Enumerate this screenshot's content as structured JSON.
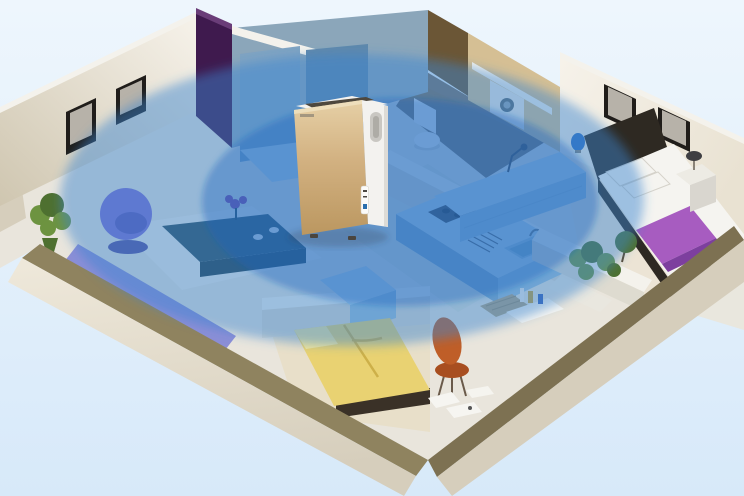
{
  "rooms": [
    "living-room",
    "hallway-closet",
    "bathroom",
    "kitchen",
    "master-bedroom",
    "second-bedroom",
    "entry-study"
  ],
  "device": {
    "type": "air-purifier"
  },
  "coverage": {
    "shape": "ellipse",
    "rings": 2
  },
  "palette": {
    "background_top": "#eef6fd",
    "background_bottom": "#d7e9f9",
    "floor_base": "#e9e5dc",
    "rug_white": "#f1efe9",
    "floor_wood": "#e8dfc9",
    "kitchen_tile": "#d9dfd2",
    "bath_floor_dark": "#55483a",
    "floor_warm": "#ece4d2",
    "wall_cream_light": "#f6f2ea",
    "wall_cream": "#e9e2d2",
    "wall_cream_dark": "#cfc6b0",
    "wall_face_outer": "#efe9db",
    "wall_face_shadow": "#d6cebc",
    "wall_top_taupe": "#8f835f",
    "wall_top_taupe_dark": "#7d7152",
    "partition_white": "#f4f2ec",
    "partition_face": "#dedbd0",
    "frame_black": "#201d1a",
    "photo_gray": "#b7b2a9",
    "purple_wall": "#3f1a4e",
    "purple_wall_light": "#6a3d78",
    "closet_blue_gray": "#8ba6ba",
    "cabinet_blue": "#7fa3c2",
    "cabinet_blue_dark": "#5f88ac",
    "bath_tile": "#d5bf94",
    "bath_tile_dark": "#6b5636",
    "washer_white": "#eceae4",
    "washer_door": "#5d6a74",
    "washer_door_inner": "#93a4b0",
    "toilet_white": "#f4f4f1",
    "toilet_shadow": "#c7c6c0",
    "counter_blue": "#bdd7e8",
    "counter_face": "#9dbfd8",
    "counter_face_dark": "#86abc6",
    "stove_dark": "#40474e",
    "burner_dark": "#262b30",
    "rack_metal": "#5a646e",
    "sink_blue": "#9cc0d6",
    "sink_inner": "#7fa9c4",
    "faucet_gray": "#6a7680",
    "lamp_dark": "#3f3f42",
    "lamp_base": "#8a8378",
    "lamp_blue": "#2f6fc0",
    "bed_dark": "#2e2922",
    "bedding_white": "#f5f4f0",
    "runner_purple": "#a75cc0",
    "runner_purple_dark": "#7d3f9e",
    "nightstand_white": "#edebe4",
    "nightstand_face": "#d9d6cf",
    "plant_green": "#6d9340",
    "plant_green_dark": "#4e7030",
    "planter_box": "#e9e7df",
    "armchair_purple": "#7e6fd2",
    "armchair_seat": "#5e55b8",
    "armchair_base": "#57519e",
    "sofa_purple": "#8b8ed6",
    "sofa_purple_dark": "#6f74c2",
    "table_teal": "#2f4f5c",
    "table_teal_dark": "#24404c",
    "flower_purple": "#8e3e9e",
    "cup_white": "#f2f1ec",
    "bed_frame_dark": "#3a3127",
    "bed_yellow": "#e9d272",
    "bed_yellow_dark": "#cdb049",
    "pillow_yellow": "#f2e59c",
    "mat_tan": "#b3a482",
    "paper_white": "#f6f5f1",
    "bottle_white": "#efeeea",
    "bottle_amber": "#c9a23a",
    "bottle_blue": "#3a62b8",
    "chair_orange": "#bf5e28",
    "chair_orange_dark": "#a84e20",
    "chair_leg": "#6a5a4a",
    "overlay_outer": "rgba(56,131,209,0.47)",
    "overlay_inner": "rgba(22,99,188,0.38)",
    "shadow_soft": "rgba(50,60,80,0.25)",
    "purifier_white": "#f3f2ef",
    "purifier_side_shade": "#dddbd6",
    "vent_dark": "#4e483e",
    "purifier_gold_light": "#e6d0a6",
    "purifier_gold": "#d2b181",
    "purifier_gold_dark": "#bb9760",
    "gold_trim": "#f0e2c2",
    "handle_shadow": "#c9c7c2",
    "handle_inner": "#aeaca6",
    "control_face": "#fbfbf9",
    "control_mark": "#4a4742",
    "control_blue": "#2a6fae",
    "brand_gray": "#8a8174",
    "foot_dark": "#4a453e"
  }
}
